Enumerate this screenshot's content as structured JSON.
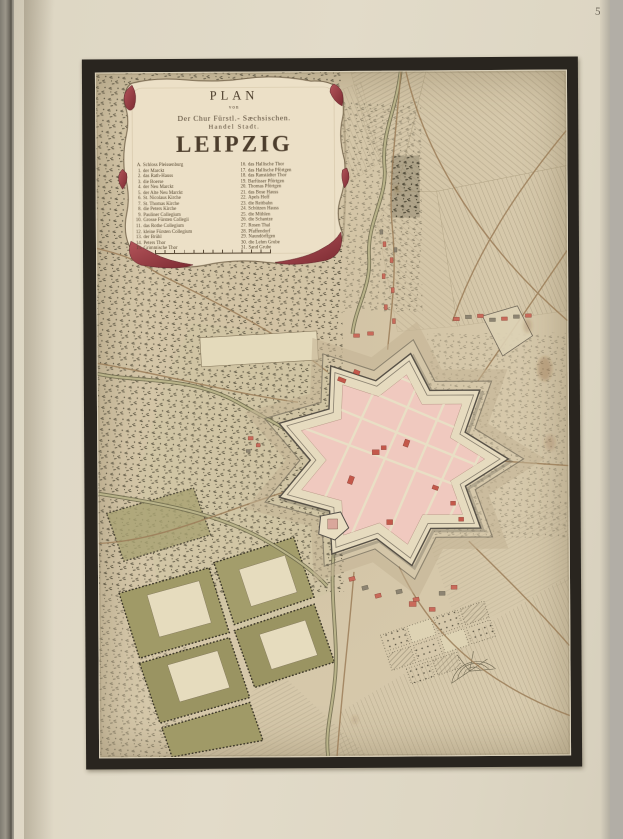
{
  "page": {
    "number": "58"
  },
  "cartouche": {
    "title": {
      "line1": "PLAN",
      "line2": "von",
      "line3": "Der Chur Fürstl.- Sæchsischen.",
      "line4": "Handel Stadt.",
      "city": "LEIPZIG"
    },
    "legend_left": [
      {
        "key": "A.",
        "label": "Schloss Pleissenburg"
      },
      {
        "key": "1.",
        "label": "der Marckt"
      },
      {
        "key": "2.",
        "label": "das Rath-Hauss"
      },
      {
        "key": "3.",
        "label": "die Boerse"
      },
      {
        "key": "4.",
        "label": "der Neu Marckt"
      },
      {
        "key": "5.",
        "label": "der Alte Neu Marckt"
      },
      {
        "key": "6.",
        "label": "St. Nicolaus Kirche"
      },
      {
        "key": "7.",
        "label": "St. Thomas Kirche"
      },
      {
        "key": "8.",
        "label": "die Peters Kirche"
      },
      {
        "key": "9.",
        "label": "Pauliner Collegium"
      },
      {
        "key": "10.",
        "label": "Grosse Fürsten Collegii"
      },
      {
        "key": "11.",
        "label": "das Rothe Collegium"
      },
      {
        "key": "12.",
        "label": "kleine Fürsten Collegium"
      },
      {
        "key": "13.",
        "label": "der Brühl"
      },
      {
        "key": "14.",
        "label": "Peters Thor"
      },
      {
        "key": "15.",
        "label": "Grimmische Thor"
      }
    ],
    "legend_right": [
      {
        "key": "16.",
        "label": "das Hallische Thor"
      },
      {
        "key": "17.",
        "label": "das Hallische Pförtgen"
      },
      {
        "key": "18.",
        "label": "das Ranstädter Thor"
      },
      {
        "key": "19.",
        "label": "Barfüsser Pförtgen"
      },
      {
        "key": "20.",
        "label": "Thomas Pförtgen"
      },
      {
        "key": "21.",
        "label": "das Bose Hauss"
      },
      {
        "key": "22.",
        "label": "Apels Hoff"
      },
      {
        "key": "23.",
        "label": "die Reitbahn"
      },
      {
        "key": "24.",
        "label": "Schützen Hauss"
      },
      {
        "key": "25.",
        "label": "die Mühlen"
      },
      {
        "key": "26.",
        "label": "die Schantze"
      },
      {
        "key": "27.",
        "label": "Rosen Thal"
      },
      {
        "key": "28.",
        "label": "Pfaffendorf"
      },
      {
        "key": "29.",
        "label": "Naundörffgen"
      },
      {
        "key": "30.",
        "label": "die Lehm Grube"
      },
      {
        "key": "31.",
        "label": "Sand Grube"
      }
    ]
  },
  "colors": {
    "paper_tan": "#d8cbae",
    "page_beige": "#ddd6c4",
    "frame_black": "#29251f",
    "parchment": "#ece0c7",
    "curl_crimson": "#a8434a",
    "city_pink": "#f0c9bf",
    "building_red": "#c4584a",
    "green_parcel": "#9f9a67",
    "river_olive": "#6e6a4c"
  }
}
